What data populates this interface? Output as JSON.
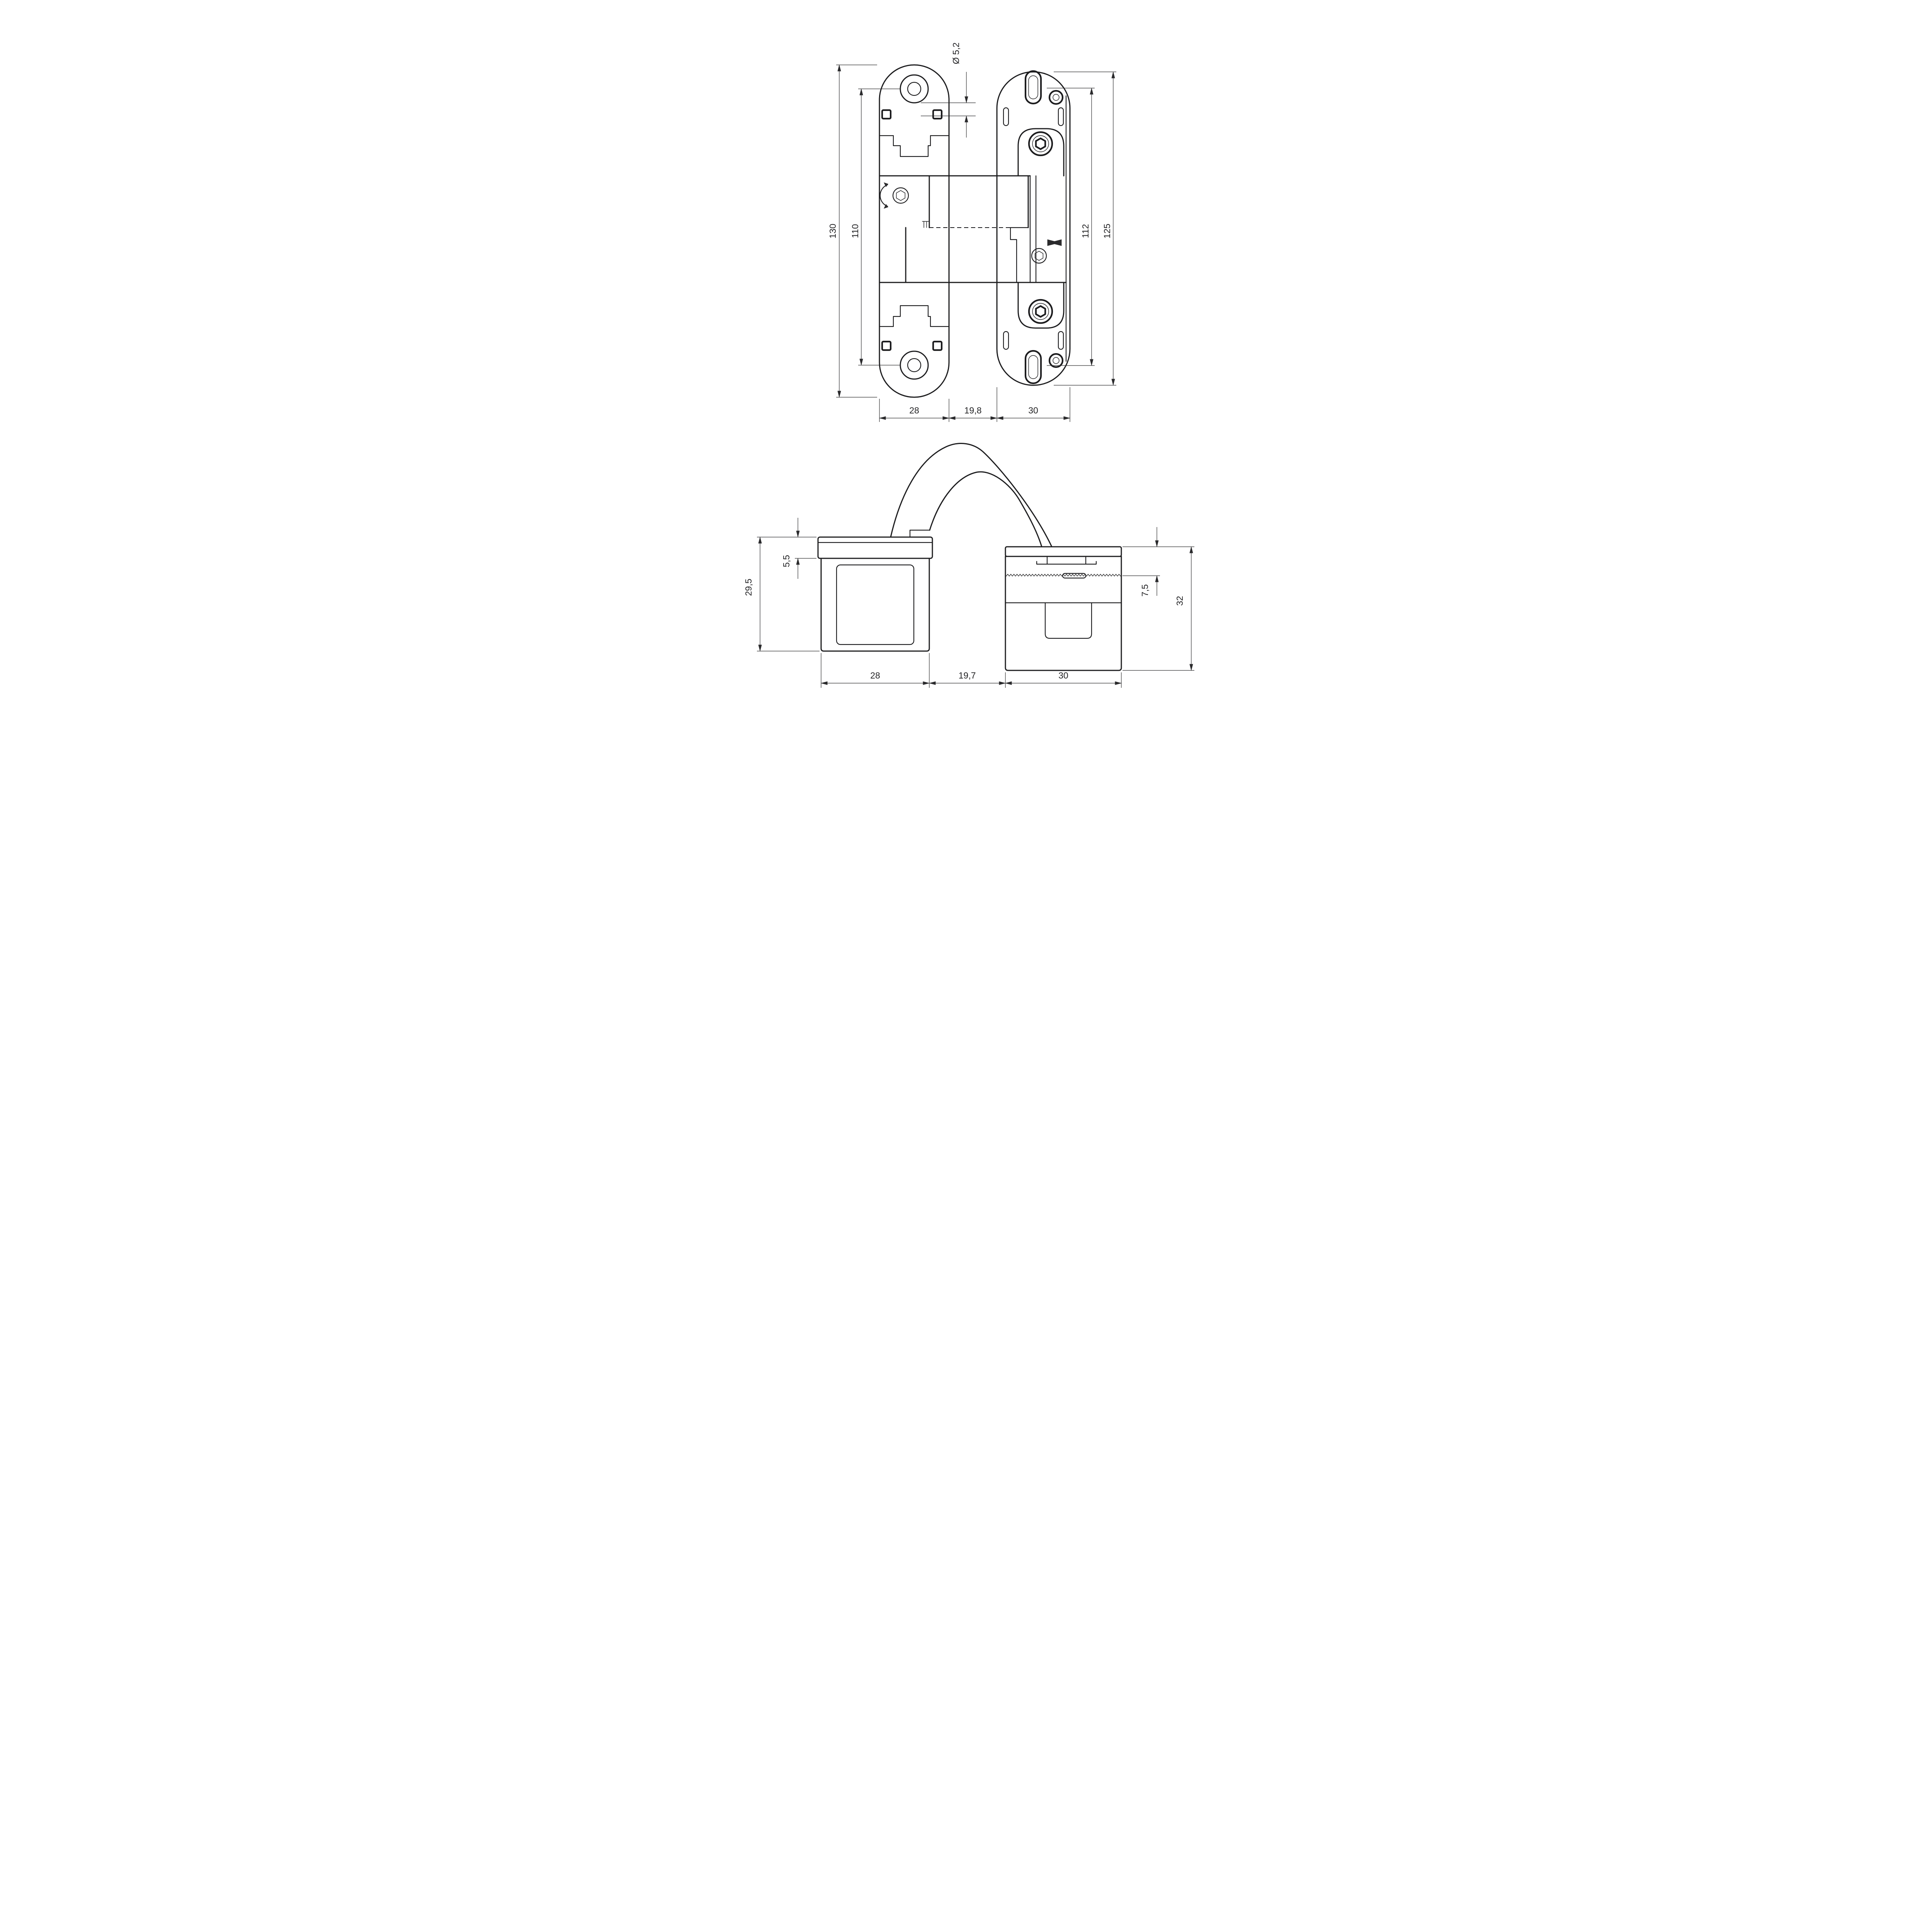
{
  "drawing": {
    "type": "technical-drawing",
    "subject": "concealed door hinge, two orthographic views with dimensions",
    "units_style": "comma decimal separator (mm)",
    "colors": {
      "line": "#1c1c1e",
      "dimension": "#2a2a2c",
      "background": "#ffffff"
    },
    "top_view": {
      "hole_diameter": "Ø 5,2",
      "left_plate_overall_height": "130",
      "left_plate_screw_distance": "110",
      "right_plate_slot_distance": "112",
      "right_plate_overall_height": "125",
      "left_plate_width": "28",
      "center_gap_width": "19,8",
      "right_plate_width": "30"
    },
    "side_view": {
      "left_block_height": "29,5",
      "left_block_cap_depth": "5,5",
      "right_block_cap_depth": "7,5",
      "right_block_height": "32",
      "left_block_width": "28",
      "center_gap_width": "19,7",
      "right_block_width": "30"
    }
  }
}
